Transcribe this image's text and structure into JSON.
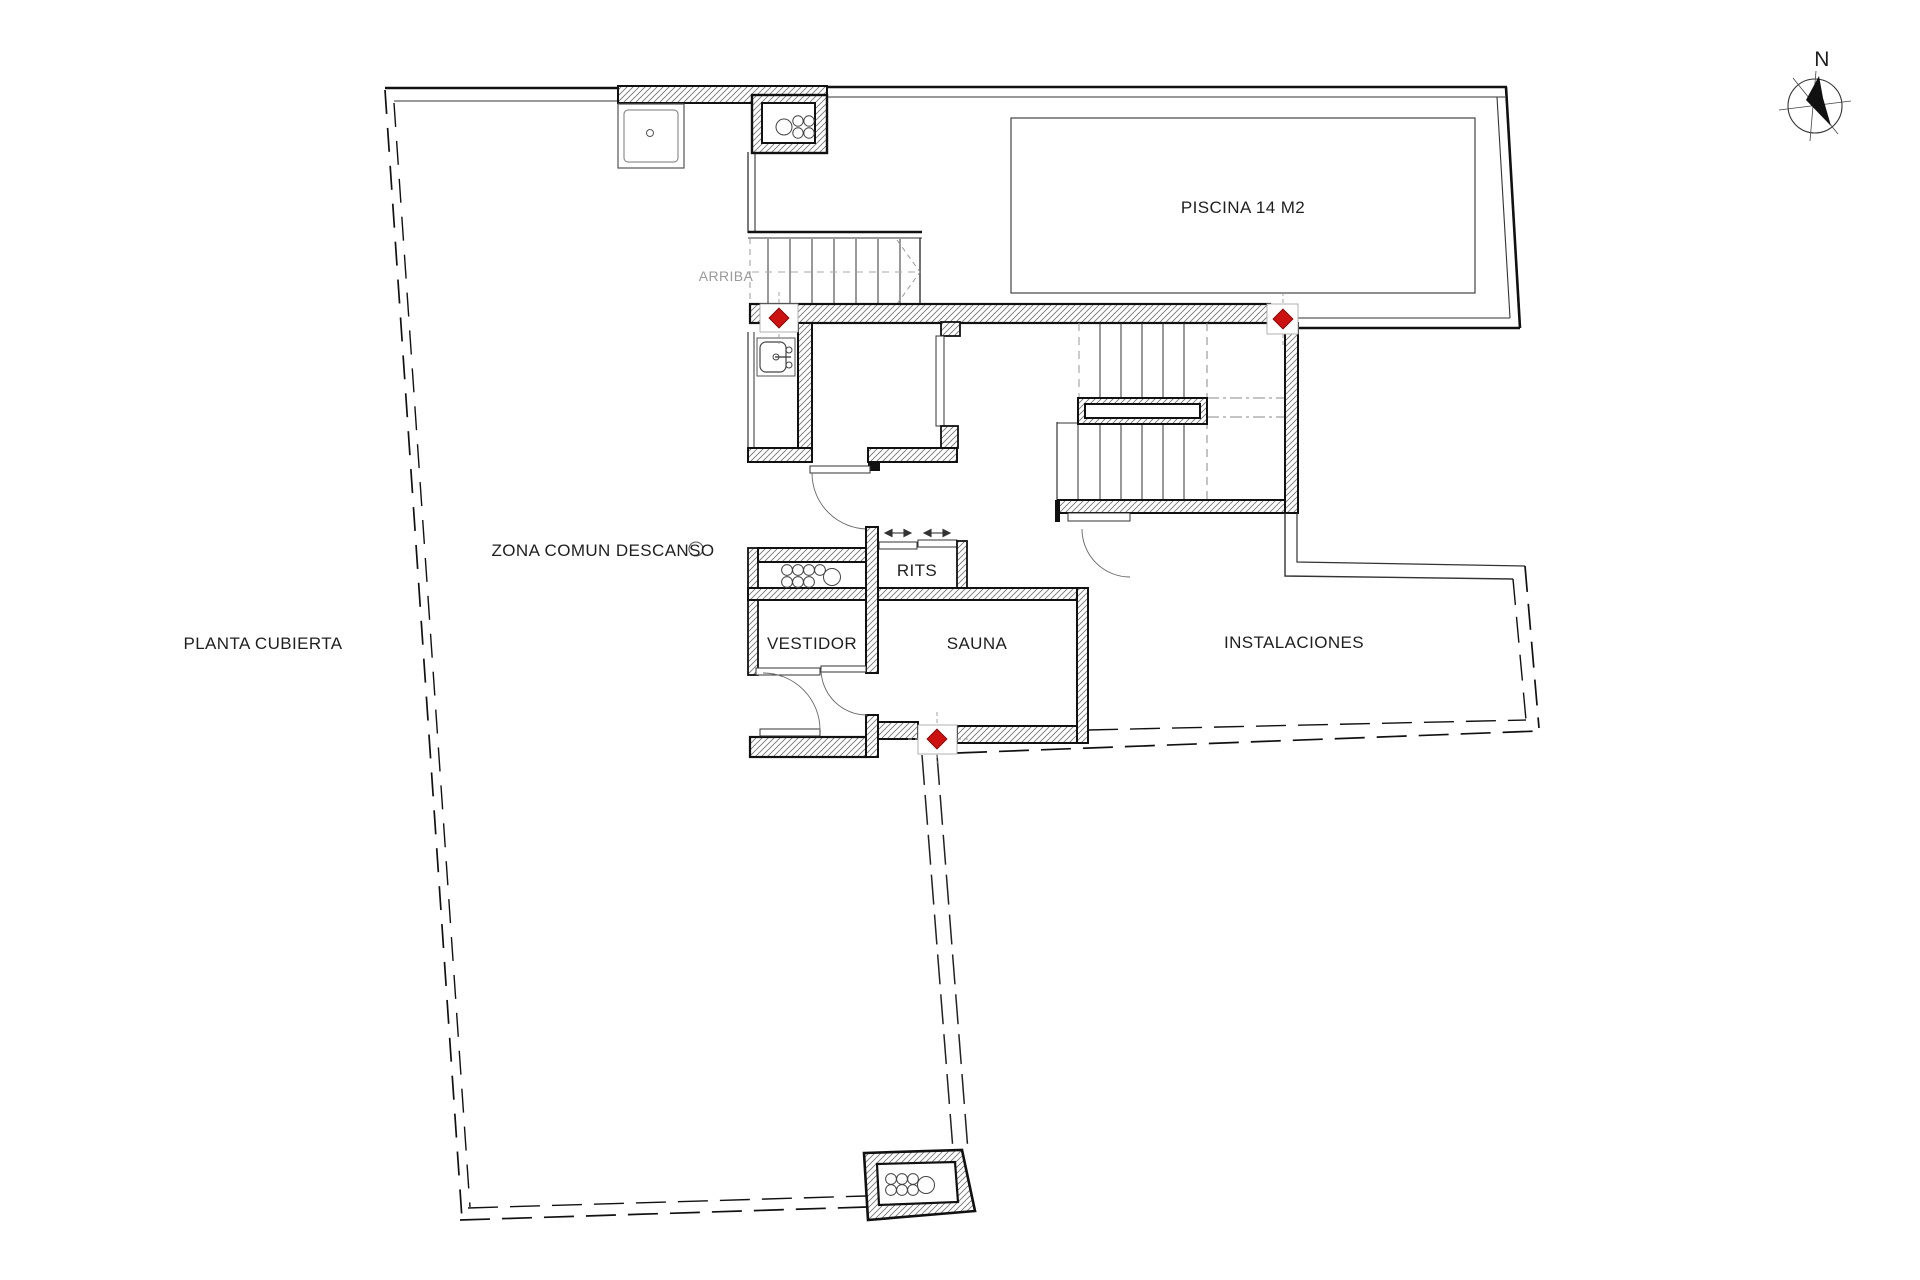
{
  "page": {
    "background": "#ffffff",
    "drawing_type": "architectural-floor-plan"
  },
  "labels": {
    "plan_title": "PLANTA CUBIERTA",
    "zona_comun": "ZONA COMUN DESCANSO",
    "piscina": "PISCINA 14 M2",
    "arriba": "ARRIBA",
    "rits": "RITS",
    "vestidor": "VESTIDOR",
    "sauna": "SAUNA",
    "instalaciones": "INSTALACIONES",
    "compass_north": "N"
  },
  "colors": {
    "wall_line": "#111111",
    "thin_line": "#333333",
    "hatch": "#777777",
    "marker_red": "#cc1111",
    "guide_gray": "#999999",
    "label_text": "#1f1f1f"
  },
  "icons": {
    "north-compass": "circle-with-black-needle",
    "sprinkler-marker": "red-diamond-in-white-box",
    "pipe-shaft": "cluster-of-circles",
    "sink": "basin-with-faucet",
    "shower-tray": "square-with-drain"
  },
  "markers": {
    "red_diamond_count": 3
  }
}
